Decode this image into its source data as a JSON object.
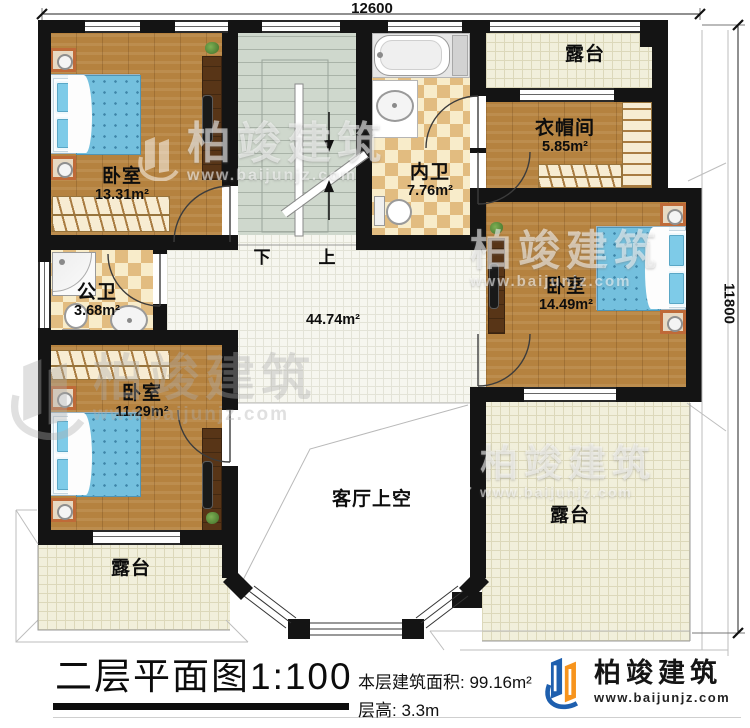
{
  "dimensions": {
    "top": "12600",
    "right": "11800"
  },
  "rooms": {
    "bedroom_top_left": {
      "name": "卧室",
      "area": "13.31m²"
    },
    "inner_bath": {
      "name": "内卫",
      "area": "7.76m²"
    },
    "terrace_top": {
      "name": "露台"
    },
    "cloakroom": {
      "name": "衣帽间",
      "area": "5.85m²"
    },
    "bedroom_right": {
      "name": "卧室",
      "area": "14.49m²"
    },
    "public_bath": {
      "name": "公卫",
      "area": "3.68m²"
    },
    "hall": {
      "area": "44.74m²"
    },
    "bedroom_bottom": {
      "name": "卧室",
      "area": "11.29m²"
    },
    "living_void": {
      "name": "客厅上空"
    },
    "terrace_bottom_left": {
      "name": "露台"
    },
    "terrace_bottom_right": {
      "name": "露台"
    }
  },
  "stairs": {
    "down_label": "下",
    "up_label": "上"
  },
  "title_block": {
    "title": "二层平面图",
    "scale": "1:100",
    "floor_area_label": "本层建筑面积:",
    "floor_area_value": "99.16m²",
    "floor_height_label": "层高:",
    "floor_height_value": "3.3m"
  },
  "brand": {
    "name": "柏竣建筑",
    "website": "www.baijunjz.com"
  },
  "watermark": {
    "name": "柏竣建筑",
    "website": "www.baijunjz.com"
  },
  "colors": {
    "wall": "#141414",
    "wood": "#b5823f",
    "bed_blue": "#74c0de",
    "brand_blue": "#1e5fae",
    "brand_orange": "#f7941d"
  }
}
